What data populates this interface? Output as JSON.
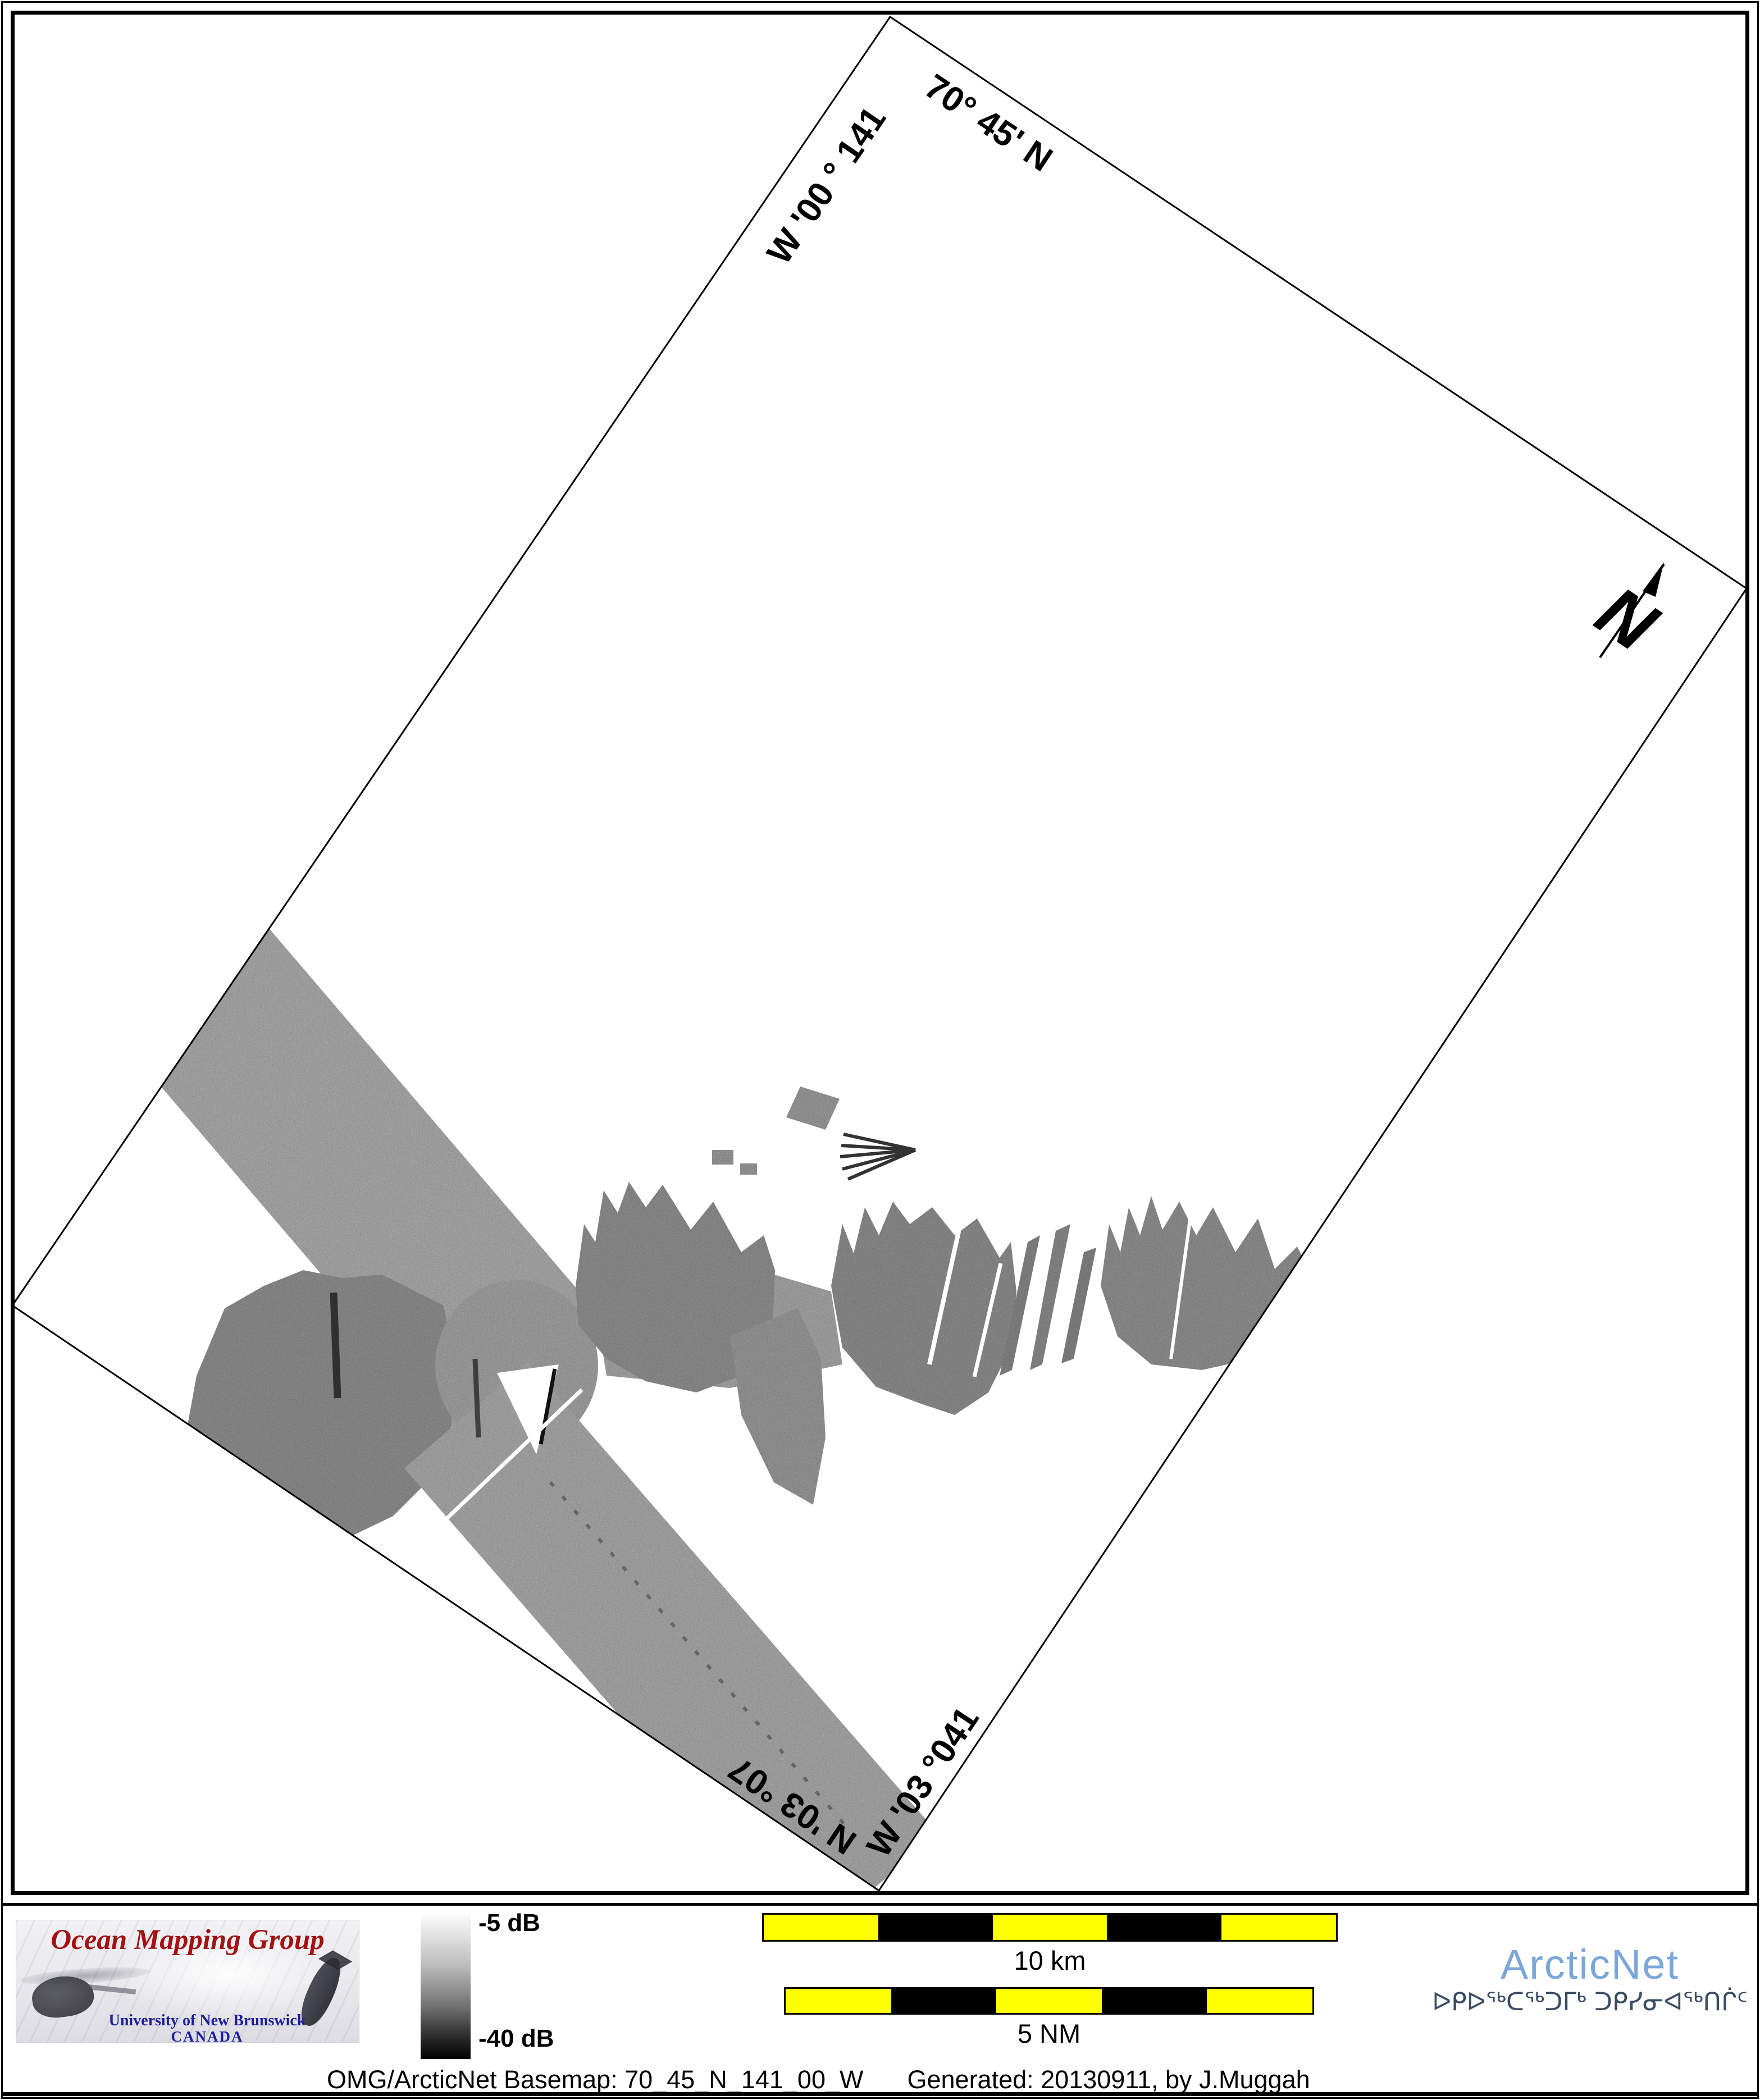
{
  "map": {
    "graticule_labels": {
      "top_right": "70° 45' N",
      "top_left": "141 ° 00' W",
      "bottom_left": "70° 30' N",
      "bottom_right": "140° 30' W"
    },
    "north_label": "N"
  },
  "legend": {
    "colorbar_top": "-5 dB",
    "colorbar_bottom": "-40 dB"
  },
  "scalebars": {
    "km_label": "10 km",
    "nm_label": "5 NM"
  },
  "logos": {
    "omg": {
      "title": "Ocean Mapping Group",
      "line1": "University of New Brunswick",
      "line2": "CANADA"
    },
    "arcticnet": {
      "name": "ArcticNet",
      "inuktitut": "ᐅᑭᐅᖅᑕᖅᑐᒥᒃ ᑐᑭᓯᓂᐊᖅᑎᒌᑦ"
    }
  },
  "caption": {
    "left": "OMG/ArcticNet Basemap: 70_45_N_141_00_W",
    "right": "Generated: 20130911, by J.Muggah"
  },
  "colors": {
    "scalebar_yellow": "#ffff00",
    "omg_red": "#a41113",
    "unb_blue": "#1e1e9c",
    "arcticnet_blue": "#7ba6d9",
    "inuktitut_navy": "#3a4c64"
  }
}
